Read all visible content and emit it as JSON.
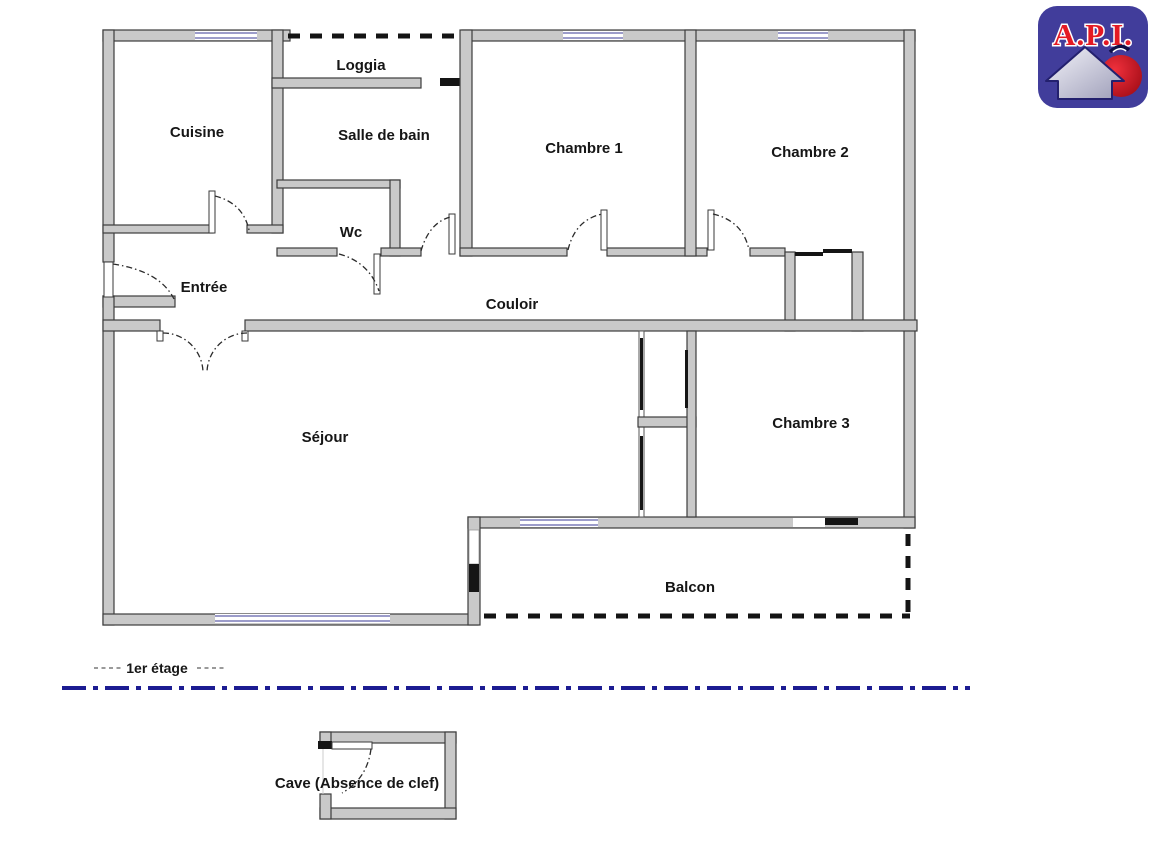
{
  "logo": {
    "text": "A.P.I."
  },
  "floor_1": {
    "label": "1er étage",
    "rooms": {
      "cuisine": "Cuisine",
      "loggia": "Loggia",
      "salle_de_bain": "Salle de bain",
      "wc": "Wc",
      "chambre_1": "Chambre 1",
      "chambre_2": "Chambre 2",
      "entree": "Entrée",
      "couloir": "Couloir",
      "sejour": "Séjour",
      "chambre_3": "Chambre 3",
      "balcon": "Balcon"
    }
  },
  "basement": {
    "label": "Cave (Absence de clef)"
  },
  "colors": {
    "wall_fill": "#c9c9c9",
    "wall_stroke": "#3d3d3d",
    "window_line": "#7b7bb8",
    "dashed_boundary": "#141414",
    "separator_line": "#1c1c92",
    "logo_background": "#413d9b",
    "logo_text": "#e41a24",
    "logo_house": "#c9c9da",
    "logo_apple": "#cc1020"
  }
}
